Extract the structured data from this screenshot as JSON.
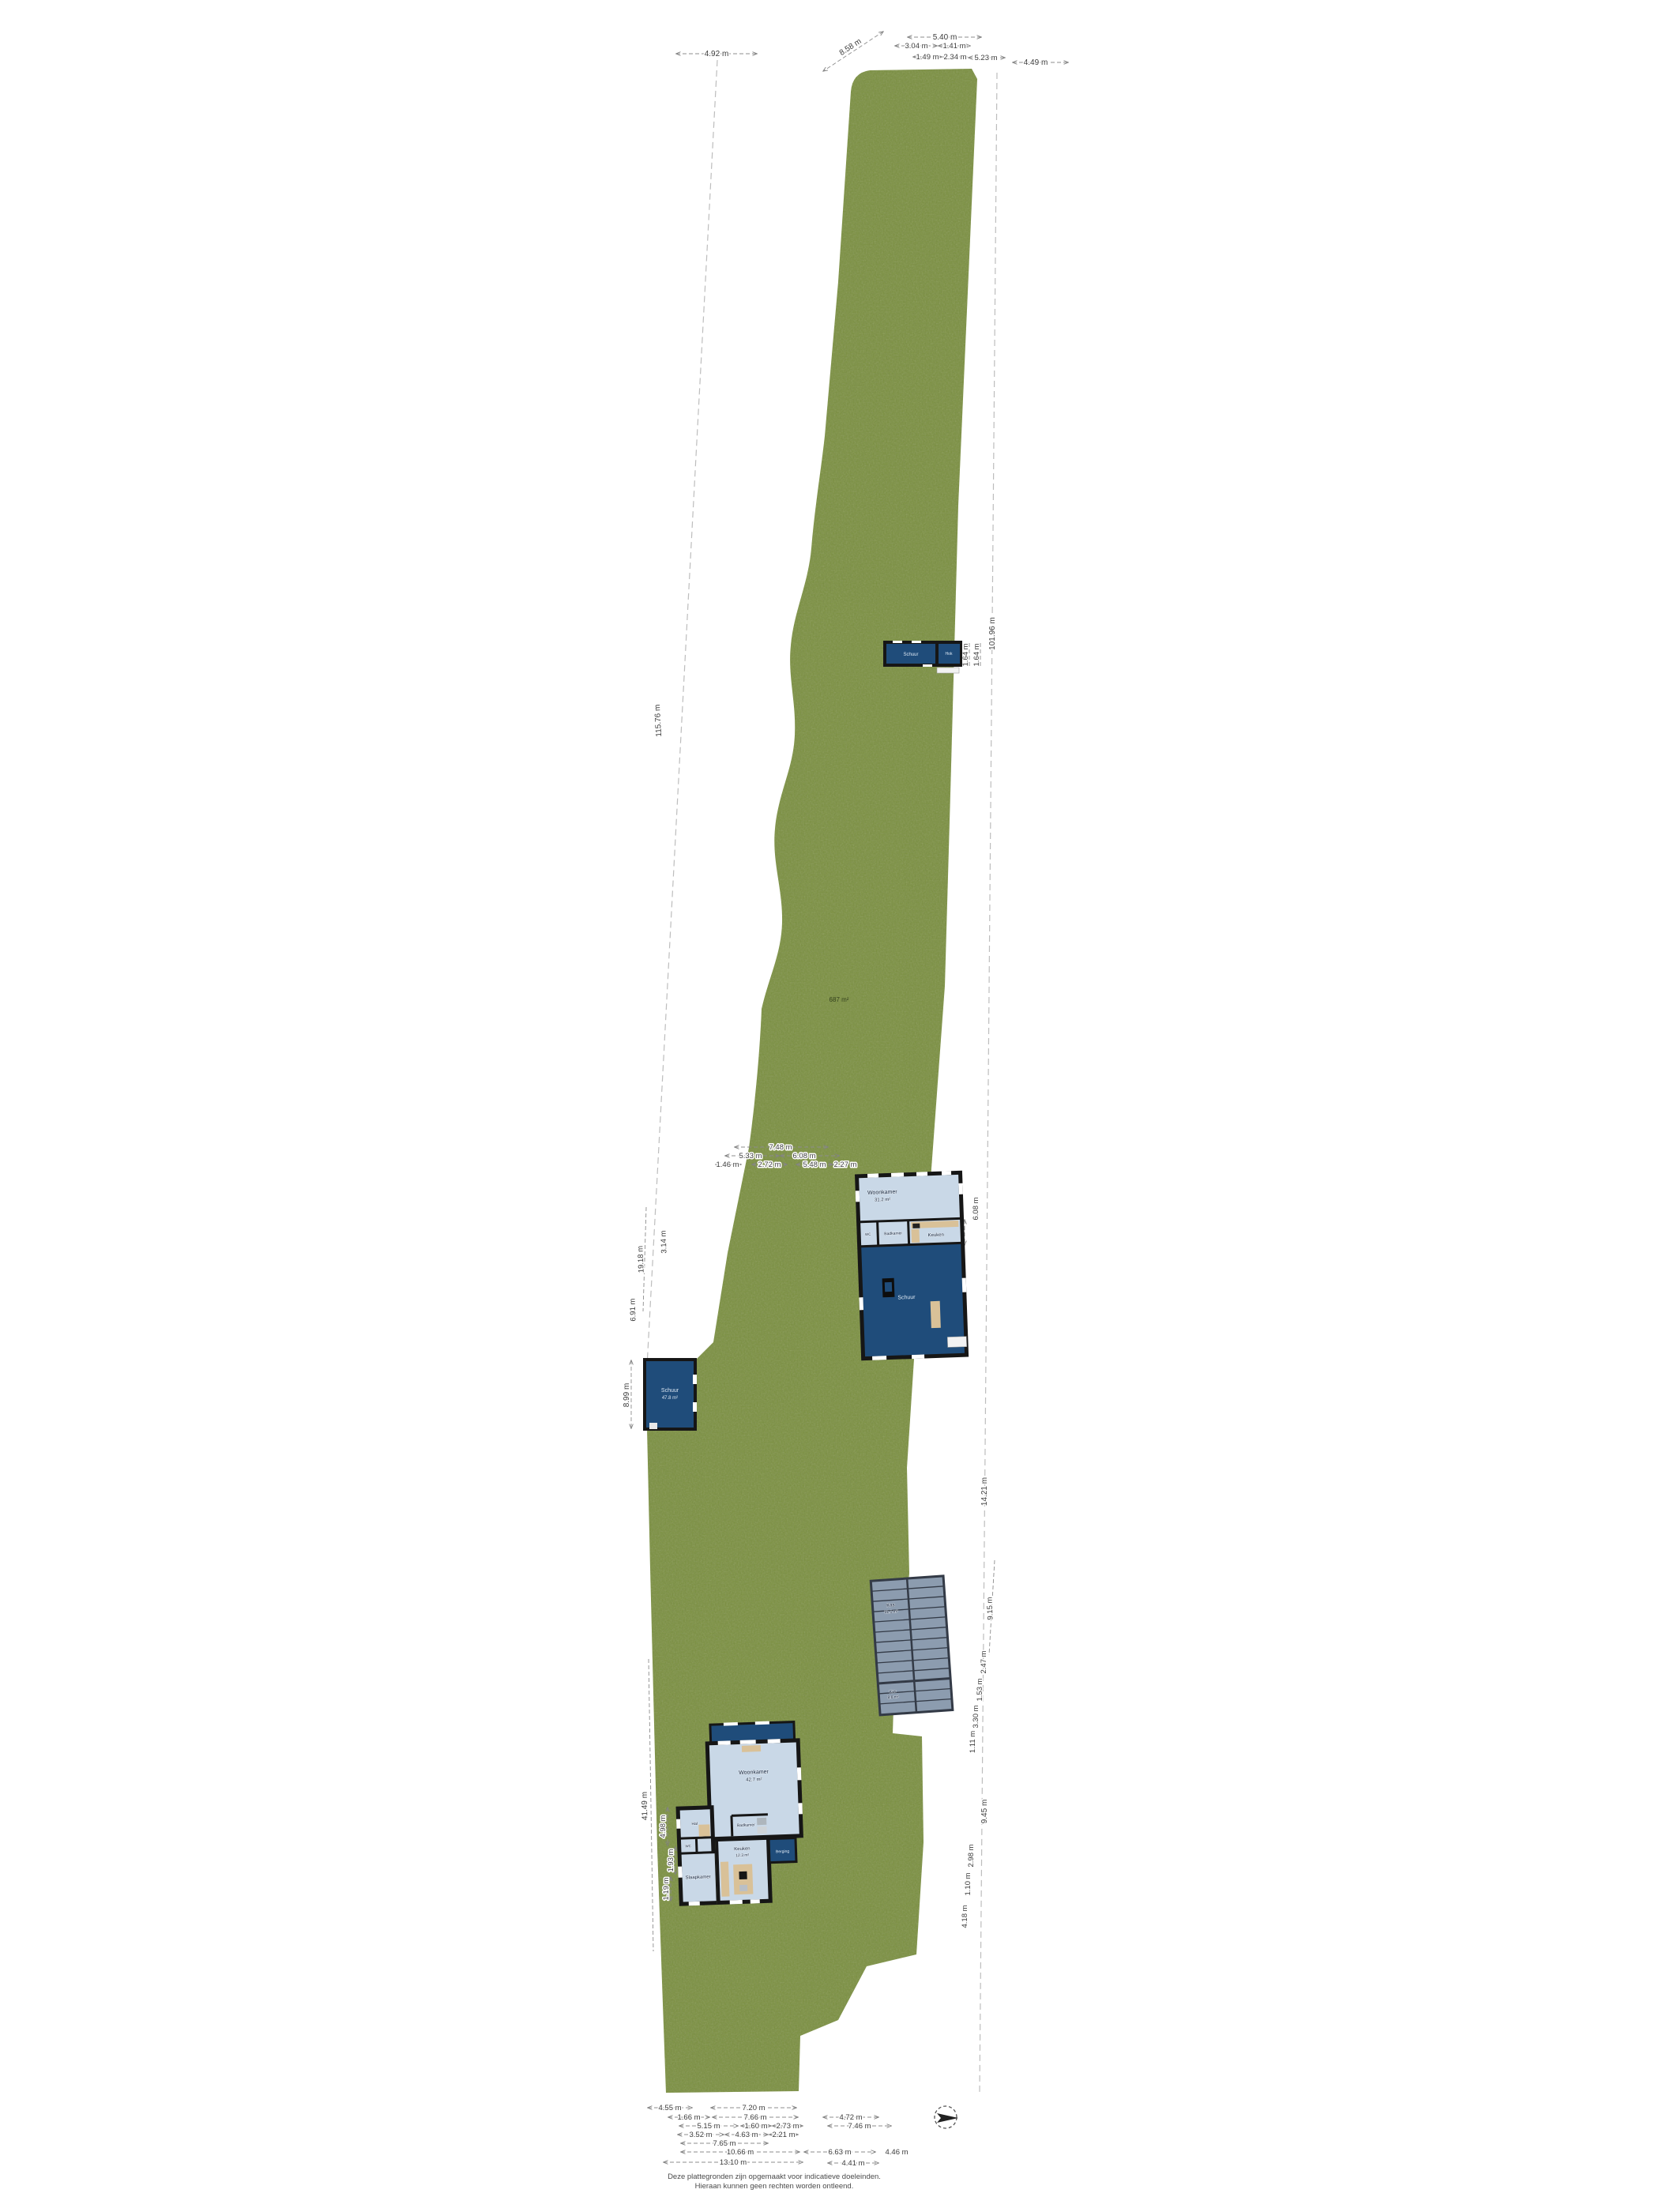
{
  "site": {
    "garden_area_label": "687 m²"
  },
  "colors": {
    "grass": "#7B9040",
    "dark_blue": "#1F4C7A",
    "light_blue": "#C9D8E7",
    "wall": "#161616",
    "beige": "#D9C198",
    "glass": "#8C9CAF"
  },
  "dims": {
    "top": [
      "4.92 m",
      "8.58 m",
      "5.40 m",
      "3.04 m",
      "1.41 m",
      "1.49 m",
      "2.34 m",
      "5.23 m",
      "4.49 m"
    ],
    "left": [
      "115.76 m",
      "19.18 m",
      "3.14 m",
      "6.91 m",
      "8.99 m",
      "41.49 m",
      "4.98 m",
      "1.93 m",
      "1.19 m"
    ],
    "right": [
      "101.96 m",
      "1.64 m",
      "1.64 m",
      "6.08 m",
      "1.68 m",
      "9.26 m",
      "14.21 m",
      "9.15 m",
      "2.47 m",
      "1.53 m",
      "3.30 m",
      "1.11 m",
      "9.45 m",
      "2.98 m",
      "1.10 m",
      "4.18 m"
    ],
    "farmhouse_top": [
      "7.48 m",
      "5.33 m",
      "6.08 m",
      "1.46 m",
      "2.72 m",
      "5.48 m",
      "2.27 m"
    ],
    "bottom": [
      "4.55 m",
      "7.20 m",
      "1.66 m",
      "7.66 m",
      "4.72 m",
      "5.15 m",
      "1.60 m",
      "2.73 m",
      "7.46 m",
      "3.52 m",
      "4.63 m",
      "2.21 m",
      "7.65 m",
      "10.66 m",
      "6.63 m",
      "4.46 m",
      "13.10 m",
      "4.41 m"
    ]
  },
  "buildings": {
    "shed_top": {
      "room1_label": "Schuur",
      "room2_label": "Hok"
    },
    "farmhouse": {
      "woonkamer_label": "Woonkamer",
      "woonkamer_area": "31.2 m²",
      "badkamer_label": "Badkamer",
      "wc_label": "WC",
      "keuken_label": "Keuken",
      "schuur_label": "Schuur"
    },
    "shed_mid": {
      "label": "Schuur",
      "area": "47.8 m²"
    },
    "greenhouse": {
      "section1_label": "Kas",
      "section1_area": "31.1 m²",
      "section2_label": "Kas",
      "section2_area": "8.6 m²"
    },
    "house": {
      "woonkamer_label": "Woonkamer",
      "woonkamer_area": "42.7 m²",
      "hal_label": "Hal",
      "badkamer_label": "Badkamer",
      "wc_label": "WC",
      "slaapkamer_label": "Slaapkamer",
      "keuken_label": "Keuken",
      "keuken_area": "12.3 m²",
      "berging_label": "Berging"
    }
  },
  "disclaimer": {
    "line1": "Deze plattegronden zijn opgemaakt voor indicatieve doeleinden.",
    "line2": "Hieraan kunnen geen rechten worden ontleend."
  }
}
